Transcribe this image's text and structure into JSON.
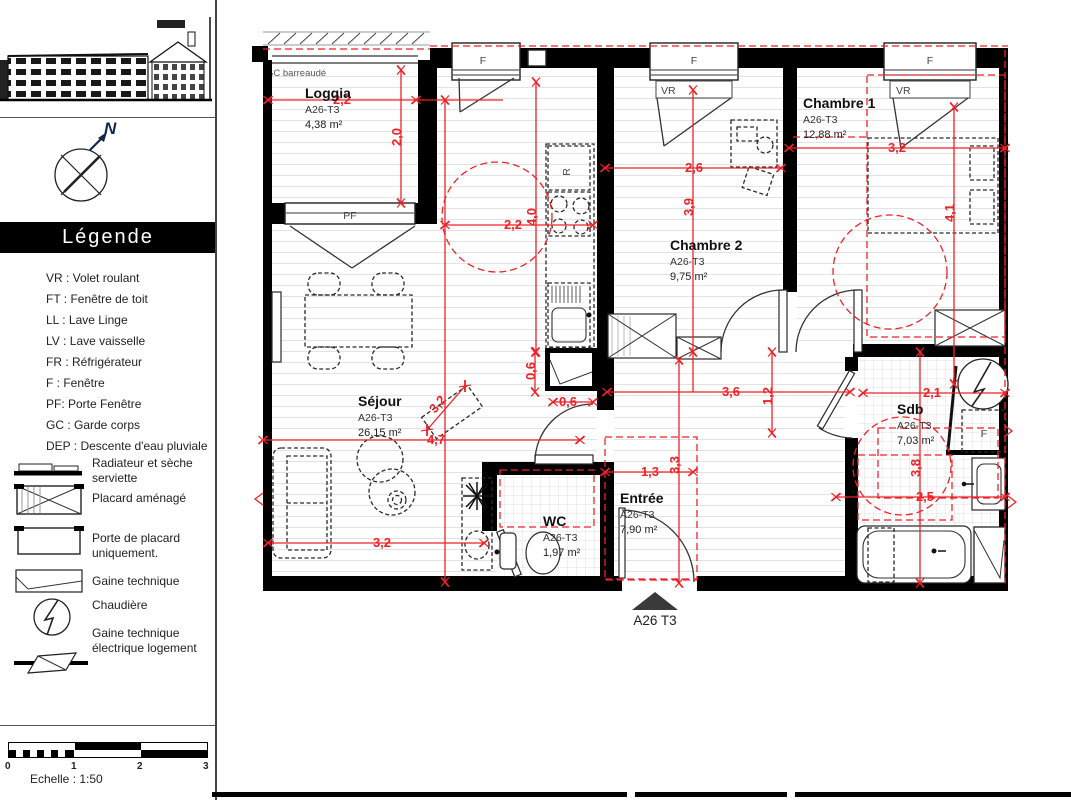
{
  "sidebar": {
    "legend_title": "Légende",
    "compass_label": "N",
    "abbreviations": [
      "VR : Volet roulant",
      "FT : Fenêtre de toit",
      "LL : Lave Linge",
      "LV : Lave vaisselle",
      "FR : Réfrigérateur",
      "F : Fenêtre",
      "PF: Porte Fenêtre",
      "GC : Garde corps",
      "DEP : Descente d'eau pluviale"
    ],
    "symbols": [
      "Radiateur et sèche serviette",
      "Placard aménagé",
      "Porte de placard uniquement.",
      "Gaine technique",
      "Chaudière",
      "Gaine technique électrique logement"
    ],
    "scale": {
      "caption": "Echelle : 1:50",
      "ticks": [
        "0",
        "1",
        "2",
        "3"
      ]
    }
  },
  "plan": {
    "unit_label": "A26 T3",
    "gc_label": "GC barreaudé",
    "window_labels": {
      "f": "F",
      "vr": "VR",
      "pf": "PF"
    },
    "kitchen_fridge_label": "R",
    "rooms": [
      {
        "name": "Loggia",
        "code": "A26-T3",
        "area": "4,38 m²"
      },
      {
        "name": "Séjour",
        "code": "A26-T3",
        "area": "26,15 m²"
      },
      {
        "name": "Chambre 1",
        "code": "A26-T3",
        "area": "12,88 m²"
      },
      {
        "name": "Chambre 2",
        "code": "A26-T3",
        "area": "9,75 m²"
      },
      {
        "name": "WC",
        "code": "A26-T3",
        "area": "1,97 m²"
      },
      {
        "name": "Entrée",
        "code": "A26-T3",
        "area": "7,90 m²"
      },
      {
        "name": "Sdb",
        "code": "A26-T3",
        "area": "7,03 m²"
      }
    ],
    "dimensions": [
      "2,2",
      "2,0",
      "4,0",
      "2,2",
      "2,6",
      "3,9",
      "3,2",
      "4,1",
      "3,6",
      "1,2",
      "0,6",
      "0,6",
      "4,7",
      "3,2",
      "3,2",
      "1,3",
      "3,3",
      "2,1",
      "3,8",
      "2,5"
    ],
    "colors": {
      "dimension_red": "#ee2228",
      "wall_black": "#000000"
    }
  }
}
